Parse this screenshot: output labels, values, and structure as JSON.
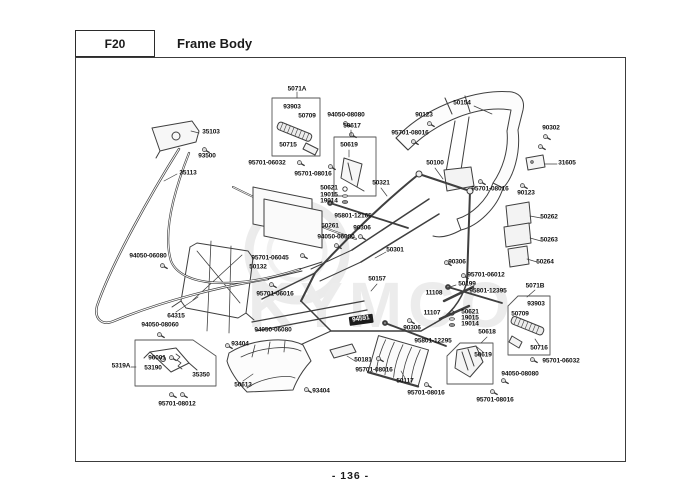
{
  "header": {
    "code": "F20",
    "title": "Frame Body"
  },
  "footer": {
    "page_number": "- 136 -"
  },
  "watermark": {
    "text": "KYMCO"
  },
  "diagram": {
    "description": "Exploded parts view of scooter frame body with callout part numbers",
    "group_boxes": [
      "5071A",
      "50619",
      "5071B",
      "50618",
      "5319A"
    ],
    "labels": [
      {
        "text": "5071A",
        "x": 297,
        "y": 90
      },
      {
        "text": "93903",
        "x": 292,
        "y": 108
      },
      {
        "text": "50709",
        "x": 307,
        "y": 117
      },
      {
        "text": "50715",
        "x": 288,
        "y": 146
      },
      {
        "text": "94050-08080",
        "x": 346,
        "y": 116
      },
      {
        "text": "50617",
        "x": 352,
        "y": 127
      },
      {
        "text": "50619",
        "x": 349,
        "y": 146
      },
      {
        "text": "95701-06032",
        "x": 267,
        "y": 164
      },
      {
        "text": "95701-08016",
        "x": 313,
        "y": 175
      },
      {
        "text": "90123",
        "x": 424,
        "y": 116
      },
      {
        "text": "95701-08016",
        "x": 410,
        "y": 134
      },
      {
        "text": "50154",
        "x": 462,
        "y": 104
      },
      {
        "text": "90302",
        "x": 551,
        "y": 129
      },
      {
        "text": "31605",
        "x": 567,
        "y": 164
      },
      {
        "text": "50100",
        "x": 435,
        "y": 164
      },
      {
        "text": "95701-08016",
        "x": 490,
        "y": 190
      },
      {
        "text": "90123",
        "x": 526,
        "y": 194
      },
      {
        "text": "50262",
        "x": 549,
        "y": 218
      },
      {
        "text": "50263",
        "x": 549,
        "y": 241
      },
      {
        "text": "50264",
        "x": 545,
        "y": 263
      },
      {
        "text": "35103",
        "x": 211,
        "y": 133
      },
      {
        "text": "93500",
        "x": 207,
        "y": 157
      },
      {
        "text": "35113",
        "x": 188,
        "y": 174
      },
      {
        "text": "94050-06080",
        "x": 148,
        "y": 257
      },
      {
        "text": "64315",
        "x": 176,
        "y": 317
      },
      {
        "text": "94050-08060",
        "x": 160,
        "y": 326
      },
      {
        "text": "96001",
        "x": 157,
        "y": 359
      },
      {
        "text": "5319A",
        "x": 121,
        "y": 367
      },
      {
        "text": "53190",
        "x": 153,
        "y": 369
      },
      {
        "text": "35350",
        "x": 201,
        "y": 376
      },
      {
        "text": "95701-08012",
        "x": 177,
        "y": 405
      },
      {
        "text": "93404",
        "x": 240,
        "y": 345
      },
      {
        "text": "50613",
        "x": 243,
        "y": 386
      },
      {
        "text": "93404",
        "x": 321,
        "y": 392
      },
      {
        "text": "95701-06045",
        "x": 270,
        "y": 259
      },
      {
        "text": "50132",
        "x": 258,
        "y": 268
      },
      {
        "text": "95701-06016",
        "x": 275,
        "y": 295
      },
      {
        "text": "94050-06080",
        "x": 273,
        "y": 331
      },
      {
        "text": "50621",
        "x": 329,
        "y": 189
      },
      {
        "text": "19015",
        "x": 329,
        "y": 196
      },
      {
        "text": "19014",
        "x": 329,
        "y": 202
      },
      {
        "text": "95801-12165",
        "x": 353,
        "y": 217
      },
      {
        "text": "50261",
        "x": 330,
        "y": 227
      },
      {
        "text": "90306",
        "x": 362,
        "y": 229
      },
      {
        "text": "94050-06080",
        "x": 336,
        "y": 238
      },
      {
        "text": "50321",
        "x": 381,
        "y": 184
      },
      {
        "text": "50301",
        "x": 395,
        "y": 251
      },
      {
        "text": "50157",
        "x": 377,
        "y": 280
      },
      {
        "text": "94591",
        "x": 361,
        "y": 320,
        "inverse": true
      },
      {
        "text": "11108",
        "x": 434,
        "y": 294
      },
      {
        "text": "11107",
        "x": 432,
        "y": 314
      },
      {
        "text": "90306",
        "x": 412,
        "y": 329
      },
      {
        "text": "95801-12295",
        "x": 433,
        "y": 342
      },
      {
        "text": "50181",
        "x": 363,
        "y": 361
      },
      {
        "text": "95701-08016",
        "x": 374,
        "y": 371
      },
      {
        "text": "50117",
        "x": 405,
        "y": 382
      },
      {
        "text": "95701-08016",
        "x": 426,
        "y": 394
      },
      {
        "text": "90306",
        "x": 457,
        "y": 263
      },
      {
        "text": "95701-06012",
        "x": 486,
        "y": 276
      },
      {
        "text": "50199",
        "x": 467,
        "y": 285
      },
      {
        "text": "95801-12395",
        "x": 488,
        "y": 292
      },
      {
        "text": "50621",
        "x": 470,
        "y": 313
      },
      {
        "text": "19015",
        "x": 470,
        "y": 319
      },
      {
        "text": "19014",
        "x": 470,
        "y": 325
      },
      {
        "text": "50618",
        "x": 487,
        "y": 333
      },
      {
        "text": "5071B",
        "x": 535,
        "y": 287
      },
      {
        "text": "93903",
        "x": 536,
        "y": 305
      },
      {
        "text": "50709",
        "x": 520,
        "y": 315
      },
      {
        "text": "50716",
        "x": 539,
        "y": 349
      },
      {
        "text": "95701-06032",
        "x": 561,
        "y": 362
      },
      {
        "text": "94050-08080",
        "x": 520,
        "y": 375
      },
      {
        "text": "50619",
        "x": 483,
        "y": 356
      },
      {
        "text": "95701-08016",
        "x": 495,
        "y": 401
      }
    ]
  }
}
